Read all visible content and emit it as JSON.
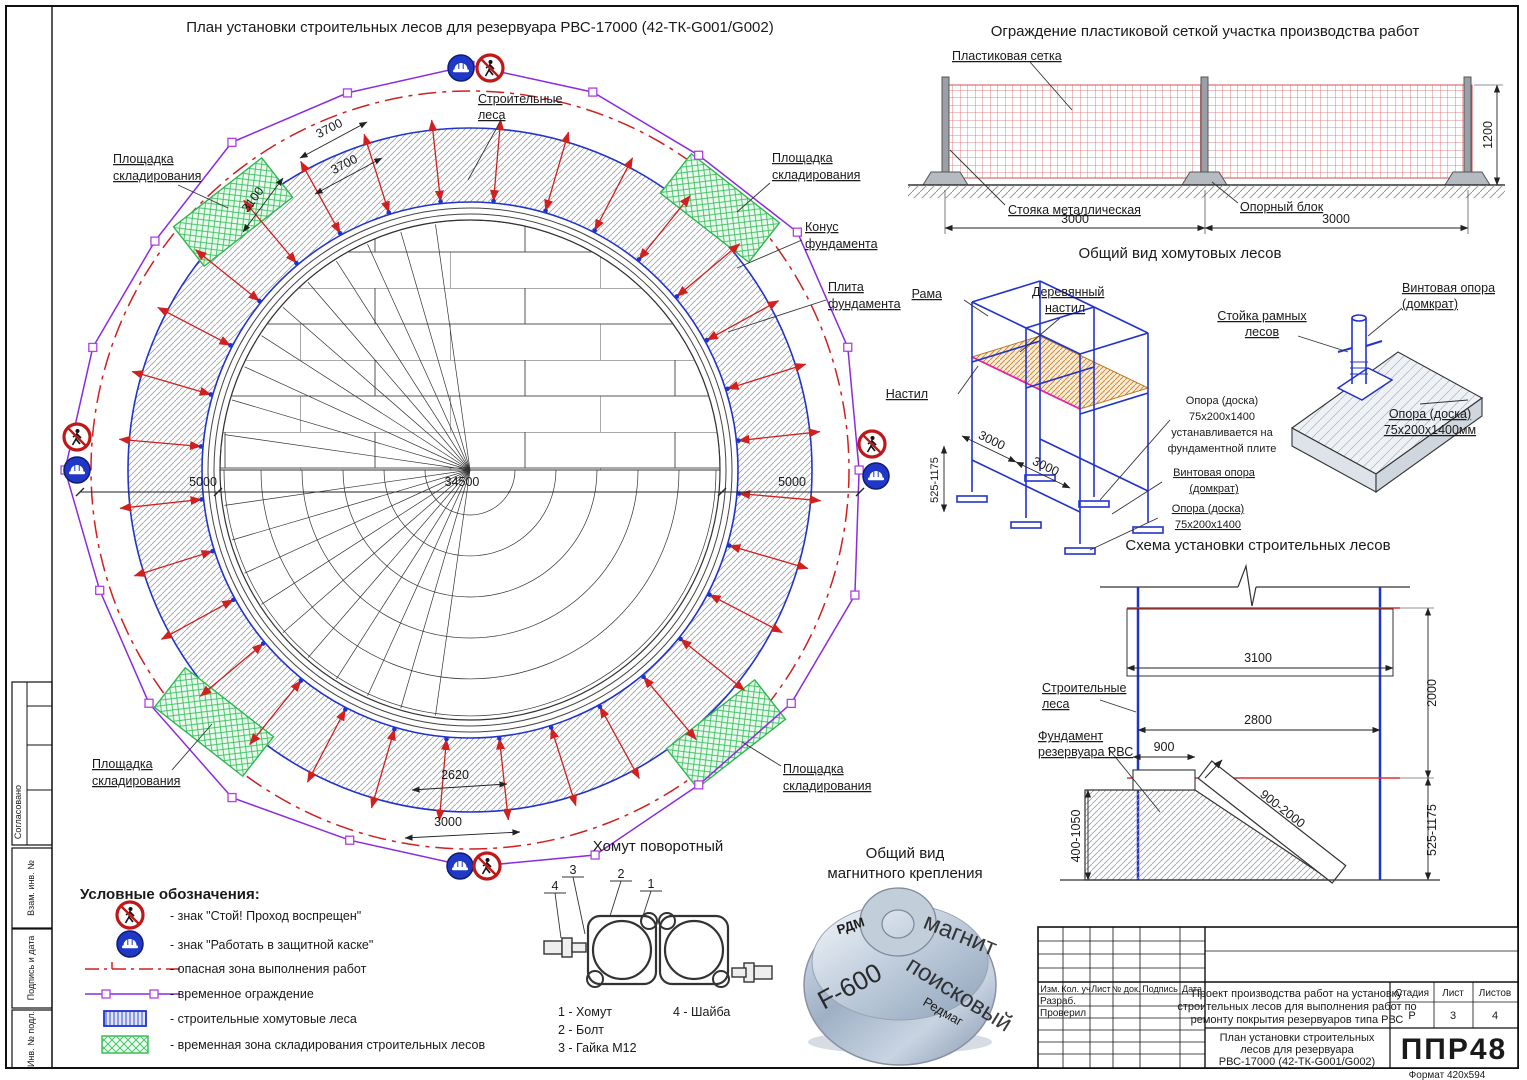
{
  "sheet": {
    "format": "Формат 420х594"
  },
  "side": {
    "s1": "Согласовано",
    "s2": "Взам. инв. №",
    "s3": "Подпись и дата",
    "s4": "Инв. № подл."
  },
  "plan": {
    "title": "План установки строительных лесов для резервуара РВС-17000 (42-ТК-G001/G002)",
    "scaffold": [
      "Строительные",
      "леса"
    ],
    "storage": [
      "Площадка",
      "складирования"
    ],
    "cone": [
      "Конус",
      "фундамента"
    ],
    "plate": [
      "Плита",
      "фундамента"
    ],
    "d3700": "3700",
    "d3100": "3100",
    "d5000": "5000",
    "d34500": "34500",
    "d2620": "2620",
    "d3000": "3000"
  },
  "fence": {
    "title": "Ограждение пластиковой сеткой участка производства работ",
    "mesh": "Пластиковая сетка",
    "post": "Стояка металлическая",
    "block": "Опорный блок",
    "d3000": "3000",
    "d1200": "1200"
  },
  "scaffold_view": {
    "title": "Общий вид хомутовых лесов",
    "rama": "Рама",
    "wood": [
      "Деревянный",
      "настил"
    ],
    "deck": "Настил",
    "d3000": "3000",
    "d525": "525-1175",
    "note": [
      "Опора (доска)",
      "75х200х1400",
      "устанавливается на",
      "фундаментной плите"
    ],
    "screw": [
      "Винтовая опора",
      "(домкрат)"
    ],
    "board": [
      "Опора (доска)",
      "75х200х1400"
    ],
    "stand": [
      "Стойка рамных",
      "лесов"
    ],
    "screw2": [
      "Винтовая опора",
      "(домкрат)"
    ],
    "board2": [
      "Опора (доска)",
      "75х200х1400мм"
    ]
  },
  "schema": {
    "title": "Схема установки строительных лесов",
    "scaffold": [
      "Строительные",
      "леса"
    ],
    "foundation": [
      "Фундамент",
      "резервуара РВС"
    ],
    "d3100": "3100",
    "d2800": "2800",
    "d900": "900",
    "d2000": "2000",
    "slope": "900-2000",
    "d400": "400-1050",
    "d525": "525-1175"
  },
  "swivel": {
    "title": "Хомут поворотный",
    "n1": "1",
    "n2": "2",
    "n3": "3",
    "n4": "4",
    "p1": "1 - Хомут",
    "p2": "2 - Болт",
    "p3": "3 - Гайка М12",
    "p4": "4 - Шайба"
  },
  "magnet": {
    "t1": "Общий вид",
    "t2": "магнитного крепления",
    "m1": "магнит",
    "m2": "поисковый",
    "m3": "F-600",
    "m4": "Редмаг",
    "m5": "РДМ"
  },
  "legend": {
    "title": "Условные обозначения:",
    "i1": "- знак \"Стой! Проход воспрещен\"",
    "i2": "- знак \"Работать в защитной каске\"",
    "i3": "- опасная зона выполнения работ",
    "i4": "- временное ограждение",
    "i5": "- строительные хомутовые леса",
    "i6": "- временная зона складирования строительных лесов"
  },
  "stamp": {
    "c1": "Изм.",
    "c2": "Кол. уч",
    "c3": "Лист",
    "c4": "№ док.",
    "c5": "Подпись",
    "c6": "Дата",
    "r1": "Разраб.",
    "r2": "Проверил",
    "p1": "Проект производства работ на установку",
    "p2": "строительных лесов для выполнения работ по",
    "p3": "ремонту покрытия резервуаров типа РВС",
    "t1": "План установки строительных",
    "t2": "лесов для резервуара",
    "t3": "РВС-17000 (42-ТК-G001/G002)",
    "h1": "Стадия",
    "h2": "Лист",
    "h3": "Листов",
    "v1": "Р",
    "v2": "3",
    "v3": "4",
    "logo": "ППР48"
  }
}
